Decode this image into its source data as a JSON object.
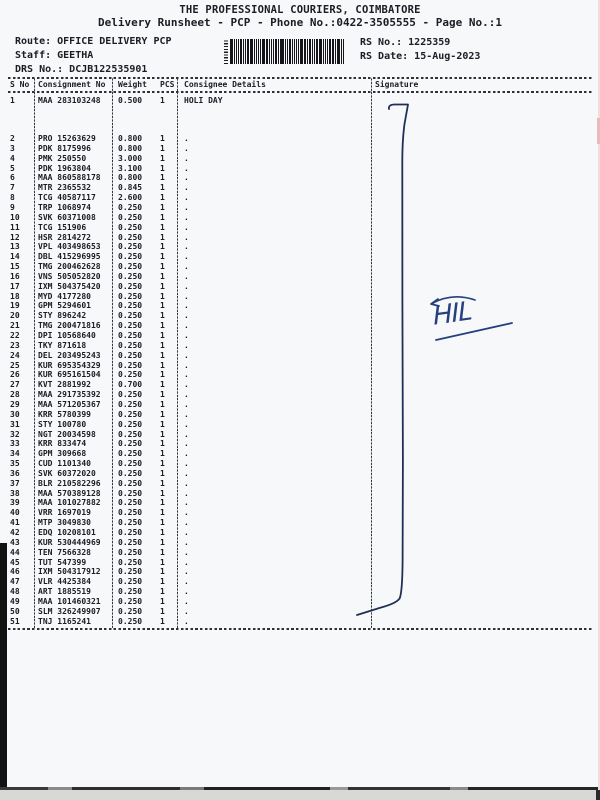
{
  "header": {
    "company": "THE PROFESSIONAL COURIERS, COIMBATORE",
    "subtitle": "Delivery Runsheet - PCP - Phone No.:0422-3505555 - Page No.:1",
    "route": "Route: OFFICE DELIVERY PCP",
    "staff": "Staff: GEETHA",
    "drs_no": "DRS No.: DCJB122535901",
    "rs_no": "RS No.: 1225359",
    "rs_date": "RS Date: 15-Aug-2023"
  },
  "table": {
    "columns": [
      "S No",
      "Consignment No",
      "Weight",
      "PCS",
      "Consignee Details",
      "Signature"
    ],
    "rows": [
      [
        "1",
        "MAA 283103248",
        "0.500",
        "1",
        "HOLI DAY"
      ],
      [
        "2",
        "PRO 15263629",
        "0.800",
        "1",
        "."
      ],
      [
        "3",
        "PDK 8175996",
        "0.800",
        "1",
        "."
      ],
      [
        "4",
        "PMK 250550",
        "3.000",
        "1",
        "."
      ],
      [
        "5",
        "PDK 1963804",
        "3.100",
        "1",
        "."
      ],
      [
        "6",
        "MAA 860588178",
        "0.800",
        "1",
        "."
      ],
      [
        "7",
        "MTR 2365532",
        "0.845",
        "1",
        "."
      ],
      [
        "8",
        "TCG 40587117",
        "2.600",
        "1",
        "."
      ],
      [
        "9",
        "TRP 1068974",
        "0.250",
        "1",
        "."
      ],
      [
        "10",
        "SVK 60371008",
        "0.250",
        "1",
        "."
      ],
      [
        "11",
        "TCG 151906",
        "0.250",
        "1",
        "."
      ],
      [
        "12",
        "HSR 2814272",
        "0.250",
        "1",
        "."
      ],
      [
        "13",
        "VPL 403498653",
        "0.250",
        "1",
        "."
      ],
      [
        "14",
        "DBL 415296995",
        "0.250",
        "1",
        "."
      ],
      [
        "15",
        "TMG 200462628",
        "0.250",
        "1",
        "."
      ],
      [
        "16",
        "VNS 505052820",
        "0.250",
        "1",
        "."
      ],
      [
        "17",
        "IXM 504375420",
        "0.250",
        "1",
        "."
      ],
      [
        "18",
        "MYD 4177280",
        "0.250",
        "1",
        "."
      ],
      [
        "19",
        "GPM 5294601",
        "0.250",
        "1",
        "."
      ],
      [
        "20",
        "STY 896242",
        "0.250",
        "1",
        "."
      ],
      [
        "21",
        "TMG 200471816",
        "0.250",
        "1",
        "."
      ],
      [
        "22",
        "DPI 10568640",
        "0.250",
        "1",
        "."
      ],
      [
        "23",
        "TKY 871618",
        "0.250",
        "1",
        "."
      ],
      [
        "24",
        "DEL 203495243",
        "0.250",
        "1",
        "."
      ],
      [
        "25",
        "KUR 695354329",
        "0.250",
        "1",
        "."
      ],
      [
        "26",
        "KUR 695161504",
        "0.250",
        "1",
        "."
      ],
      [
        "27",
        "KVT 2881992",
        "0.700",
        "1",
        "."
      ],
      [
        "28",
        "MAA 291735392",
        "0.250",
        "1",
        "."
      ],
      [
        "29",
        "MAA 571205367",
        "0.250",
        "1",
        "."
      ],
      [
        "30",
        "KRR 5780399",
        "0.250",
        "1",
        "."
      ],
      [
        "31",
        "STY 100780",
        "0.250",
        "1",
        "."
      ],
      [
        "32",
        "NGT 20034598",
        "0.250",
        "1",
        "."
      ],
      [
        "33",
        "KRR 833474",
        "0.250",
        "1",
        "."
      ],
      [
        "34",
        "GPM 309668",
        "0.250",
        "1",
        "."
      ],
      [
        "35",
        "CUD 1101340",
        "0.250",
        "1",
        "."
      ],
      [
        "36",
        "SVK 60372020",
        "0.250",
        "1",
        "."
      ],
      [
        "37",
        "BLR 210582296",
        "0.250",
        "1",
        "."
      ],
      [
        "38",
        "MAA 570389128",
        "0.250",
        "1",
        "."
      ],
      [
        "39",
        "MAA 101027882",
        "0.250",
        "1",
        "."
      ],
      [
        "40",
        "VRR 1697019",
        "0.250",
        "1",
        "."
      ],
      [
        "41",
        "MTP 3049830",
        "0.250",
        "1",
        "."
      ],
      [
        "42",
        "EDQ 10208101",
        "0.250",
        "1",
        "."
      ],
      [
        "43",
        "KUR 530444969",
        "0.250",
        "1",
        "."
      ],
      [
        "44",
        "TEN 7566328",
        "0.250",
        "1",
        "."
      ],
      [
        "45",
        "TUT 547399",
        "0.250",
        "1",
        "."
      ],
      [
        "46",
        "IXM 504317912",
        "0.250",
        "1",
        "."
      ],
      [
        "47",
        "VLR 4425384",
        "0.250",
        "1",
        "."
      ],
      [
        "48",
        "ART 1885519",
        "0.250",
        "1",
        "."
      ],
      [
        "49",
        "MAA 101460321",
        "0.250",
        "1",
        "."
      ],
      [
        "50",
        "SLM 326249907",
        "0.250",
        "1",
        "."
      ],
      [
        "51",
        "TNJ 1165241",
        "0.250",
        "1",
        "."
      ]
    ]
  },
  "signature": {
    "annotation": "HIL"
  },
  "colors": {
    "print_ink": "#1b1c24",
    "pen_ink": "#24417e",
    "paper": "#f7f8fa"
  }
}
